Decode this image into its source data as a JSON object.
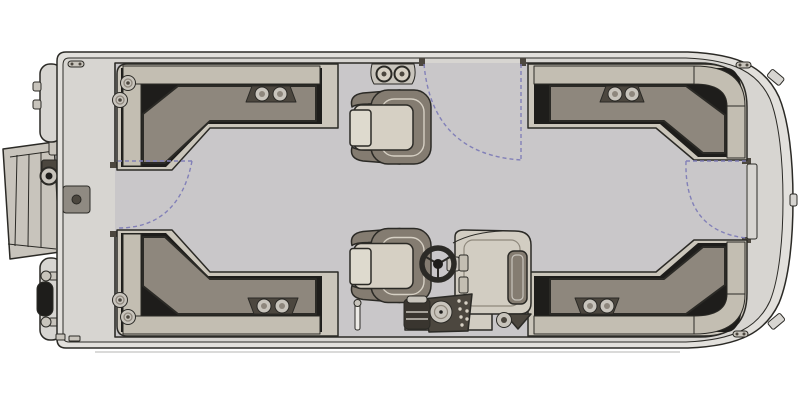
{
  "title": "Pontoon Boat Floor Plan — Overhead View",
  "canvas": {
    "width": 800,
    "height": 400
  },
  "orientation": {
    "bow": "right",
    "stern": "left",
    "port_side": "top",
    "starboard_side": "bottom"
  },
  "counts": {
    "corner_lounges": 4,
    "captain_chairs": 2,
    "gates": 3,
    "cupholder_stations": 5,
    "mooring_cleats": 3
  },
  "components": [
    {
      "id": "hull-deck",
      "label": "Pontoon hull deck with rub rail"
    },
    {
      "id": "interior-floor",
      "label": "Interior vinyl floor"
    },
    {
      "id": "swim-ladder",
      "label": "Stern swim ladder (stowed)"
    },
    {
      "id": "pontoon-tube-caps",
      "label": "Pontoon tube end caps"
    },
    {
      "id": "transom-motor-fittings",
      "label": "Transom motor and tie-down fittings"
    },
    {
      "id": "stern-docking-light",
      "label": "Stern docking light"
    },
    {
      "id": "ski-tow-base",
      "label": "Ski tow / accessory base plate"
    },
    {
      "id": "lounge-stern-port",
      "label": "Stern port L-shaped lounge"
    },
    {
      "id": "lounge-stern-starboard",
      "label": "Stern starboard L-shaped lounge"
    },
    {
      "id": "lounge-bow-port",
      "label": "Bow port L-shaped lounge"
    },
    {
      "id": "lounge-bow-starboard",
      "label": "Bow starboard L-shaped lounge"
    },
    {
      "id": "captain-chair-port",
      "label": "Port swivel captain's chair"
    },
    {
      "id": "captain-chair-starboard",
      "label": "Starboard swivel captain's chair"
    },
    {
      "id": "helm-console",
      "label": "Helm console with windscreen"
    },
    {
      "id": "steering-wheel",
      "label": "Steering wheel"
    },
    {
      "id": "gauge-cluster",
      "label": "Helm gauge and switch cluster"
    },
    {
      "id": "gate-port-side",
      "label": "Port side boarding gate swing"
    },
    {
      "id": "gate-stern",
      "label": "Stern gate swing"
    },
    {
      "id": "gate-bow",
      "label": "Bow gate swing"
    },
    {
      "id": "cupholder-stations",
      "label": "Cup holder stations"
    },
    {
      "id": "mooring-cleats",
      "label": "Mooring cleats"
    },
    {
      "id": "table-pedestal-mount",
      "label": "Table pedestal floor mount"
    },
    {
      "id": "helm-speaker",
      "label": "Helm speaker"
    },
    {
      "id": "bow-trim-tabs",
      "label": "Bow corner trim fittings"
    }
  ],
  "colors": {
    "outline": "#2b2a26",
    "black": "#1e1d1b",
    "hull_rim": "#e2e0dc",
    "deck": "#d7d5d1",
    "floor": "#c9c7c9",
    "seat_base": "#cbc6bb",
    "seat_band": "#c3beb2",
    "cushion": "#8e877d",
    "chair": "#847c71",
    "seat_light": "#d6d0c4",
    "seat_lighter": "#dedace",
    "console": "#d2cdc2",
    "dark_part": "#4c473f",
    "dark_part2": "#39352f",
    "metal": "#c8c4bc",
    "white_part": "#eceae6",
    "dash": "#8280b8"
  }
}
